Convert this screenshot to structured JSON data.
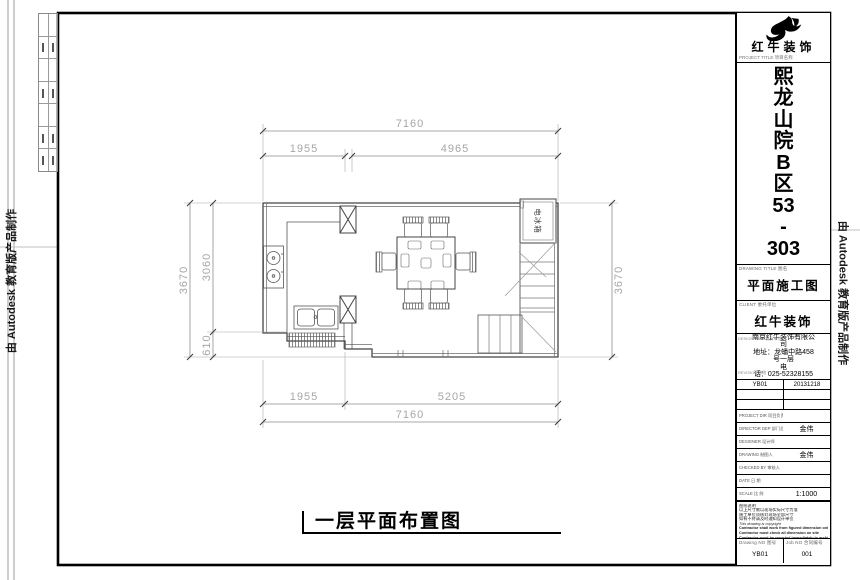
{
  "edge": {
    "autodesk_note": "由 Autodesk 教育版产品制作"
  },
  "plan": {
    "caption": "一层平面布置图",
    "fridge_label": "电冰箱",
    "dims": {
      "top_total": "7160",
      "top_left": "1955",
      "top_right": "4965",
      "left_total": "3670",
      "left_upper": "3060",
      "left_lower": "610",
      "right_total": "3670",
      "bottom_left": "1955",
      "bottom_right": "5205",
      "bottom_total": "7160"
    }
  },
  "titleblock": {
    "brand": "红牛装饰",
    "brand_sub": "PROJECT TITLE 项目名称",
    "project_chars": [
      "熙",
      "龙",
      "山",
      "院",
      "B",
      "区",
      "53",
      "-",
      "303"
    ],
    "drawing_title_label": "DRAWING TITLE 图名",
    "drawing_title": "平面施工图",
    "client_label": "CLIENT 委托单位",
    "client": "红牛装饰",
    "firm_label": "DESIGN FIRM 设计单位",
    "revision_label": "REVISION 修改",
    "firm_lines": [
      "南京红牛装饰有限公",
      "司",
      "地址：龙蟠中路458",
      "号一层",
      "电",
      "话：025-52328155"
    ],
    "revision_code": "YB01",
    "revision_date": "20131218",
    "rows": [
      {
        "label": "PROJECT DIR 项目负责人",
        "value": ""
      },
      {
        "label": "DIRECTOR DEP 部门总监",
        "value": "金伟"
      },
      {
        "label": "DESIGNER 设计师",
        "value": ""
      },
      {
        "label": "DRAWING 制图人",
        "value": "金伟"
      },
      {
        "label": "CHECKED BY 审核人",
        "value": ""
      },
      {
        "label": "DATE 日 期",
        "value": ""
      },
      {
        "label": "SCALE 比 例",
        "value": "1:1000"
      }
    ],
    "notes": [
      "图纸说明",
      "以上尺寸需以现场实际尺寸为准",
      "施工单位须核对现场全部尺寸",
      "如有不符请及时通知设计单位",
      "This drawing is copyright",
      "Contractor shall work from figured dimension only",
      "Contractor must check all dimension on site",
      "Contractor must be reported immediately to architects"
    ],
    "drawing_no_label": "Drawing NO 图号",
    "drawing_no": "YB01",
    "job_no_label": "Job NO 合同编号",
    "job_no": "001"
  }
}
